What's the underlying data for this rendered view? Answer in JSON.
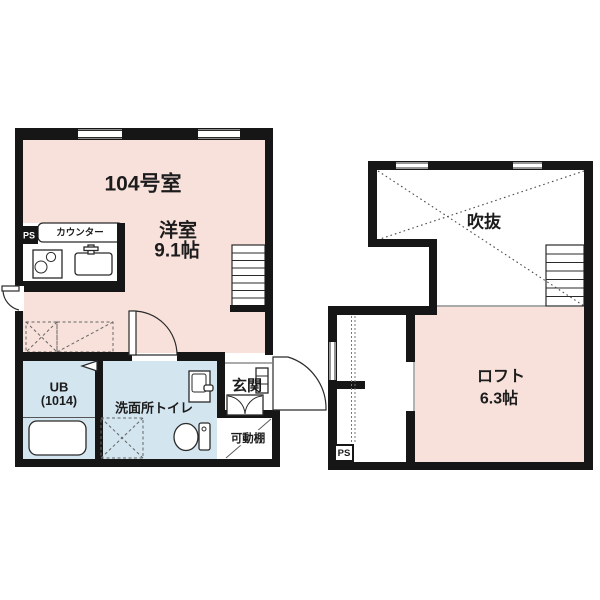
{
  "colors": {
    "room_pink": "#f8e1db",
    "wet_area_blue": "#d3e5ef",
    "wall_black": "#161616",
    "line_gray": "#4a4a4a"
  },
  "floor1": {
    "unit_number": "104号室",
    "main_room": {
      "name": "洋室",
      "size": "9.1帖"
    },
    "counter_label": "カウンター",
    "pipe_space": "PS",
    "unit_bath": {
      "name": "UB",
      "size": "(1014)"
    },
    "washroom_label": "洗面所トイレ",
    "entrance_label": "玄関",
    "movable_shelf_label": "可動棚"
  },
  "loft_floor": {
    "void_label": "吹抜",
    "loft": {
      "name": "ロフト",
      "size": "6.3帖"
    },
    "pipe_space": "PS"
  }
}
